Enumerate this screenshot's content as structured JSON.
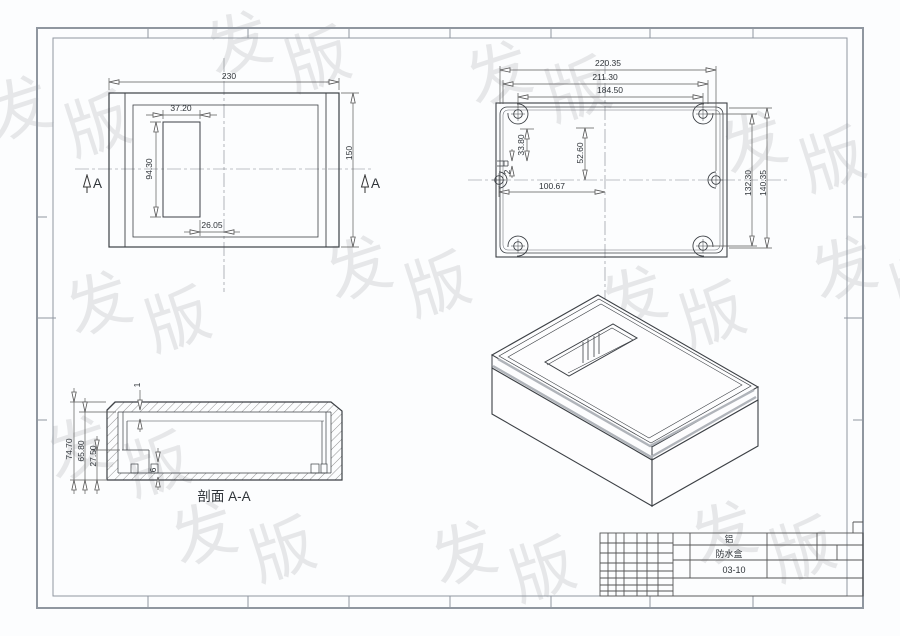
{
  "drawing": {
    "view_front": {
      "dim_width": "230",
      "dim_height": "150",
      "dim_cutout_width": "37.20",
      "dim_cutout_height": "94.30",
      "dim_cutout_offset": "26.05",
      "section_label_left": "A",
      "section_label_right": "A"
    },
    "view_back": {
      "dim_overall_width": "220.35",
      "dim_lid_width": "211.30",
      "dim_hole_span_width": "184.50",
      "dim_notch_top": "33.80",
      "dim_recess_to_center": "52.60",
      "dim_notch_height": "2",
      "dim_hole_to_center": "100.67",
      "dim_hole_span_height": "132.30",
      "dim_overall_height": "140.35"
    },
    "view_section": {
      "dim_total_height": "74.70",
      "dim_inner_height": "65.80",
      "dim_step_height": "27.50",
      "dim_lip": "1",
      "dim_bottom_thickness": "6",
      "label": "剖面 A-A"
    },
    "title_block": {
      "material": "铝",
      "part_name": "防水盒",
      "drawing_no": "03-10"
    },
    "watermark": {
      "glyph_a": "发",
      "glyph_b": "版"
    },
    "colors": {
      "line": "#3c4045",
      "dim_line": "#5a5a5a",
      "frame": "#9097a0",
      "highlight_stripe": "#b0b4ba",
      "watermark": "#7fb0d8"
    }
  }
}
